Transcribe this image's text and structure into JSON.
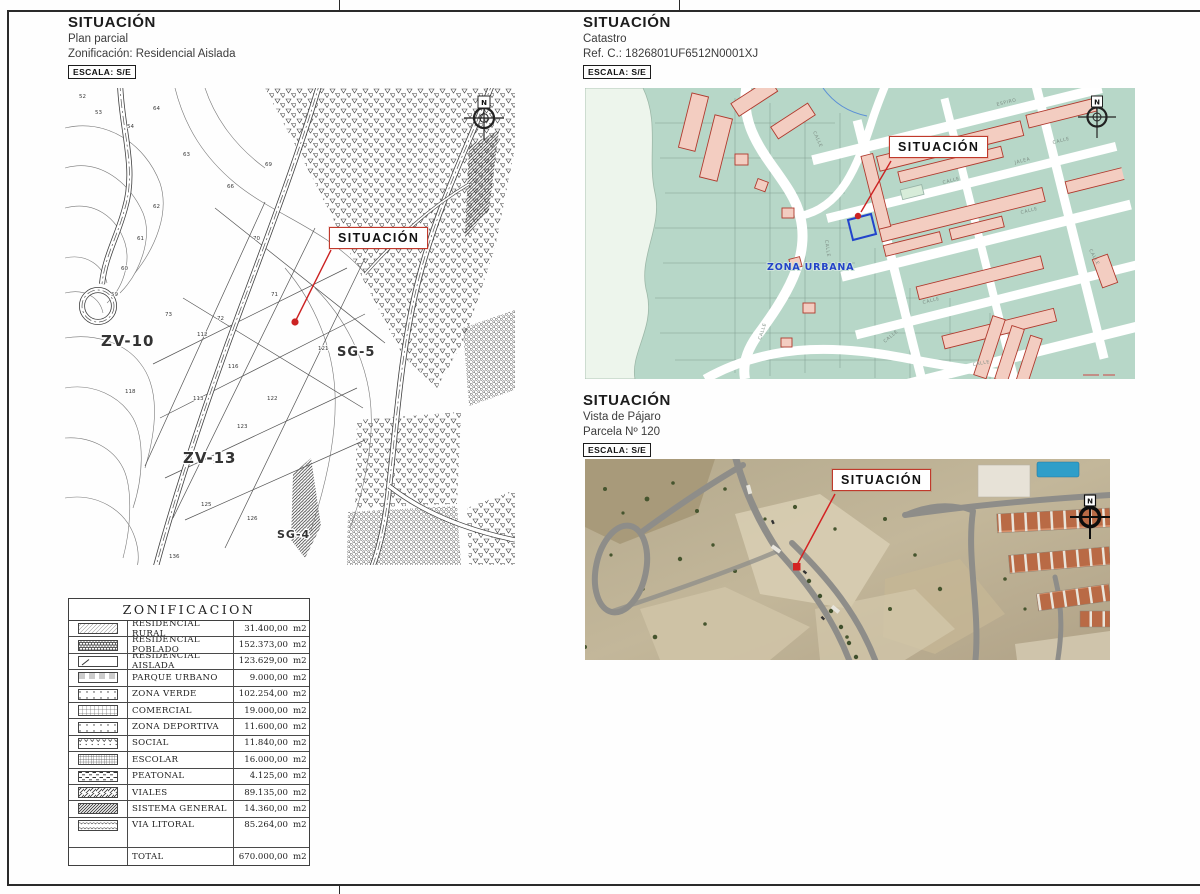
{
  "headers": {
    "plan": {
      "title": "SITUACIÓN",
      "line1": "Plan parcial",
      "line2": "Zonificación: Residencial Aislada",
      "escala": "ESCALA: S/E"
    },
    "catastro": {
      "title": "SITUACIÓN",
      "line1": "Catastro",
      "line2": "Ref. C.: 1826801UF6512N0001XJ",
      "escala": "ESCALA: S/E"
    },
    "vista": {
      "title": "SITUACIÓN",
      "line1": "Vista de Pájaro",
      "line2": "Parcela Nº 120",
      "escala": "ESCALA: S/E"
    }
  },
  "marker_label": "SITUACIÓN",
  "compass_label": "N",
  "plan_map": {
    "zone_labels": [
      {
        "t": "ZV-10",
        "x": 36,
        "y": 258,
        "s": 15
      },
      {
        "t": "ZV-13",
        "x": 118,
        "y": 375,
        "s": 15
      },
      {
        "t": "SG-5",
        "x": 272,
        "y": 268,
        "s": 13
      },
      {
        "t": "SG-4",
        "x": 212,
        "y": 450,
        "s": 11
      }
    ],
    "parcel_numbers": [
      {
        "t": "52",
        "x": 14,
        "y": 10
      },
      {
        "t": "53",
        "x": 30,
        "y": 26
      },
      {
        "t": "54",
        "x": 62,
        "y": 40
      },
      {
        "t": "64",
        "x": 88,
        "y": 22
      },
      {
        "t": "63",
        "x": 118,
        "y": 68
      },
      {
        "t": "66",
        "x": 162,
        "y": 100
      },
      {
        "t": "69",
        "x": 200,
        "y": 78
      },
      {
        "t": "70",
        "x": 188,
        "y": 152
      },
      {
        "t": "71",
        "x": 206,
        "y": 208
      },
      {
        "t": "72",
        "x": 152,
        "y": 232
      },
      {
        "t": "73",
        "x": 100,
        "y": 228
      },
      {
        "t": "59",
        "x": 46,
        "y": 208
      },
      {
        "t": "60",
        "x": 56,
        "y": 182
      },
      {
        "t": "61",
        "x": 72,
        "y": 152
      },
      {
        "t": "62",
        "x": 88,
        "y": 120
      },
      {
        "t": "112",
        "x": 132,
        "y": 248
      },
      {
        "t": "113",
        "x": 128,
        "y": 312
      },
      {
        "t": "116",
        "x": 163,
        "y": 280
      },
      {
        "t": "118",
        "x": 60,
        "y": 305
      },
      {
        "t": "121",
        "x": 253,
        "y": 262
      },
      {
        "t": "122",
        "x": 202,
        "y": 312
      },
      {
        "t": "123",
        "x": 172,
        "y": 340
      },
      {
        "t": "124",
        "x": 148,
        "y": 376
      },
      {
        "t": "125",
        "x": 136,
        "y": 418
      },
      {
        "t": "126",
        "x": 182,
        "y": 432
      },
      {
        "t": "136",
        "x": 104,
        "y": 470
      }
    ]
  },
  "catastro_map": {
    "zona_urbana": "ZONA URBANA",
    "street_labels": [
      {
        "t": "CALLE",
        "x": 176,
        "y": 252,
        "r": -72
      },
      {
        "t": "CALLE",
        "x": 228,
        "y": 44,
        "r": 66
      },
      {
        "t": "CALLE",
        "x": 240,
        "y": 152,
        "r": 82
      },
      {
        "t": "CALLE",
        "x": 338,
        "y": 216,
        "r": -14
      },
      {
        "t": "CALLE",
        "x": 436,
        "y": 126,
        "r": -14
      },
      {
        "t": "CALLE",
        "x": 358,
        "y": 96,
        "r": -14
      },
      {
        "t": "CALLE",
        "x": 468,
        "y": 56,
        "r": -14
      },
      {
        "t": "CALLE",
        "x": 504,
        "y": 162,
        "r": 62
      },
      {
        "t": "CALLE",
        "x": 388,
        "y": 278,
        "r": -10
      },
      {
        "t": "ESPIRO",
        "x": 412,
        "y": 18,
        "r": -14
      },
      {
        "t": "JALEA",
        "x": 430,
        "y": 76,
        "r": -14
      },
      {
        "t": "CALLE",
        "x": 300,
        "y": 255,
        "r": -40
      }
    ]
  },
  "zonificacion": {
    "title": "ZONIFICACION",
    "unit": "m2",
    "rows": [
      {
        "label": "RESIDENCIAL RURAL",
        "value": "31.400,00",
        "pattern": "hatch-light"
      },
      {
        "label": "RESIDENCIAL POBLADO",
        "value": "152.373,00",
        "pattern": "brick"
      },
      {
        "label": "RESIDENCIAL AISLADA",
        "value": "123.629,00",
        "pattern": "tick"
      },
      {
        "label": "PARQUE URBANO",
        "value": "9.000,00",
        "pattern": "bars"
      },
      {
        "label": "ZONA VERDE",
        "value": "102.254,00",
        "pattern": "dots"
      },
      {
        "label": "COMERCIAL",
        "value": "19.000,00",
        "pattern": "grid"
      },
      {
        "label": "ZONA DEPORTIVA",
        "value": "11.600,00",
        "pattern": "dots"
      },
      {
        "label": "SOCIAL",
        "value": "11.840,00",
        "pattern": "vees"
      },
      {
        "label": "ESCOLAR",
        "value": "16.000,00",
        "pattern": "grid-dense"
      },
      {
        "label": "PEATONAL",
        "value": "4.125,00",
        "pattern": "dashes"
      },
      {
        "label": "VIALES",
        "value": "89.135,00",
        "pattern": "diag"
      },
      {
        "label": "SISTEMA GENERAL",
        "value": "14.360,00",
        "pattern": "diag-dense"
      },
      {
        "label": "VIA LITORAL",
        "value": "85.264,00",
        "pattern": "scale"
      }
    ],
    "total_label": "TOTAL",
    "total_value": "670.000,00"
  },
  "colors": {
    "accent_red": "#cc2222",
    "cadastre_teal": "#b7d7c8",
    "building_pink": "#f3cdc1",
    "zona_urbana_blue": "#2343c8"
  }
}
